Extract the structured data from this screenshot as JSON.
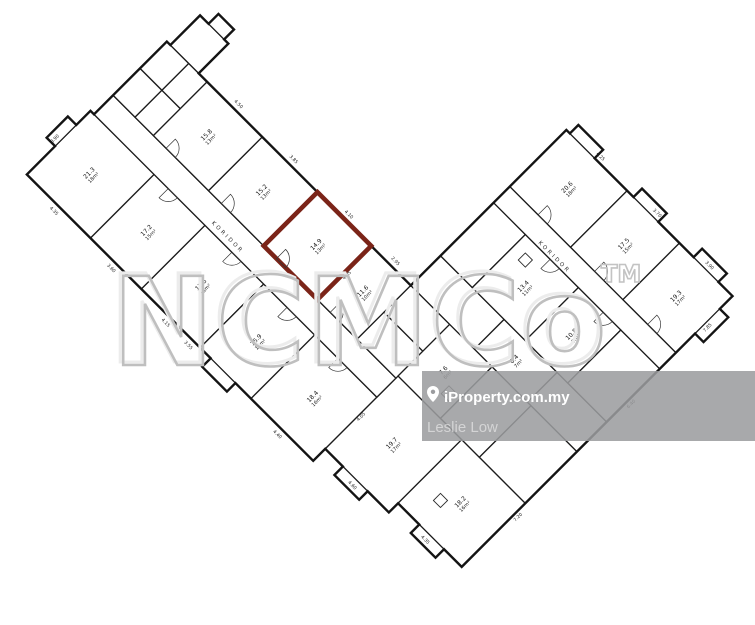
{
  "watermark": {
    "text": "NCMCo",
    "tm": "TM"
  },
  "banner": {
    "brand": "iProperty.com.my",
    "agent": "Leslie Low"
  },
  "plan": {
    "highlight_color": "#7b2418",
    "corridor_labels": [
      "KORIDOR",
      "KORIDOR"
    ],
    "rooms": [
      {
        "id": "A1",
        "l1": "21.3",
        "l2": "18m²"
      },
      {
        "id": "A2",
        "l1": "17.2",
        "l2": "15m²"
      },
      {
        "id": "A3",
        "l1": "17.6",
        "l2": "15m²"
      },
      {
        "id": "A4",
        "l1": "16.9",
        "l2": "14m²"
      },
      {
        "id": "A5",
        "l1": "18.4",
        "l2": "16m²"
      },
      {
        "id": "A6",
        "l1": "19.7",
        "l2": "17m²"
      },
      {
        "id": "A7",
        "l1": "18.2",
        "l2": "16m²"
      },
      {
        "id": "B1",
        "l1": "15.8",
        "l2": "13m²"
      },
      {
        "id": "B2",
        "l1": "15.2",
        "l2": "13m²"
      },
      {
        "id": "HL",
        "l1": "14.9",
        "l2": "13m²"
      },
      {
        "id": "B4",
        "l1": "11.6",
        "l2": "10m²"
      },
      {
        "id": "C1",
        "l1": "13.4",
        "l2": "11m²"
      },
      {
        "id": "C2",
        "l1": "10.8",
        "l2": "9m²"
      },
      {
        "id": "D1",
        "l1": "20.6",
        "l2": "18m²"
      },
      {
        "id": "D2",
        "l1": "17.5",
        "l2": "15m²"
      },
      {
        "id": "D3",
        "l1": "19.3",
        "l2": "17m²"
      },
      {
        "id": "J2",
        "l1": "8.4",
        "l2": "7m²"
      },
      {
        "id": "K1",
        "l1": "7.6",
        "l2": "6m²"
      }
    ],
    "dims": [
      "4.50",
      "3.85",
      "4.10",
      "2.95",
      "4.25",
      "3.70",
      "3.90",
      "4.35",
      "3.60",
      "4.15",
      "3.55",
      "4.40",
      "4.60",
      "4.35",
      "8.90",
      "7.85",
      "6.40",
      "7.20",
      "4.05",
      "4.05"
    ]
  }
}
